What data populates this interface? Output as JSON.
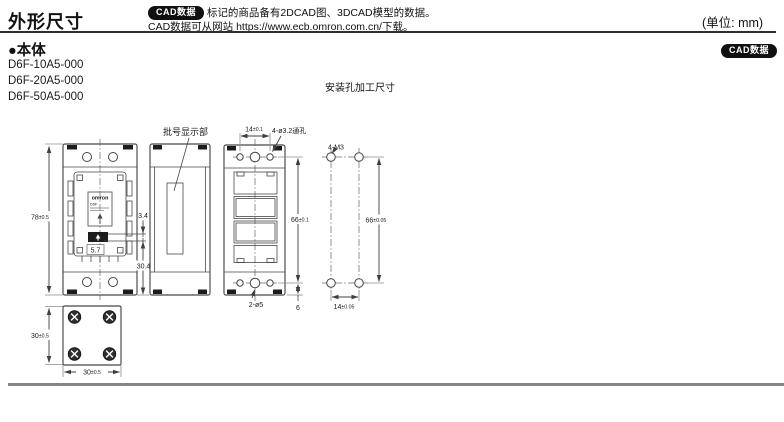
{
  "header": {
    "title": "外形尺寸",
    "cad_badge": "CAD数据",
    "note_line1": "标记的商品备有2DCAD图、3DCAD模型的数据。",
    "note_line2": "CAD数据可从网站 https://www.ecb.omron.com.cn/下载。",
    "unit_label": "(单位: mm)"
  },
  "section": {
    "heading": "●本体",
    "cad_badge": "CAD数据",
    "models": [
      "D6F-10A5-000",
      "D6F-20A5-000",
      "D6F-50A5-000"
    ],
    "mounting_title": "安装孔加工尺寸"
  },
  "front_view": {
    "height_dim": "78",
    "height_tol": "±0.5",
    "logo": "omron",
    "logo_model": "D6F",
    "dim_3_4": "3.4",
    "dim_5_7": "5.7",
    "dim_30_4": "30.4"
  },
  "side_view": {
    "callout": "批号显示部"
  },
  "back_view": {
    "top_dim": "14",
    "top_tol": "±0.1",
    "holes_label": "4-ø3.2通孔",
    "height_dim": "66",
    "height_tol": "±0.1",
    "center_holes_label": "2-ø5",
    "bottom_offset_dim": "6"
  },
  "mounting_view": {
    "screws_label": "4-M3",
    "height_dim": "66",
    "height_tol": "±0.05",
    "width_dim": "14",
    "width_tol": "±0.05"
  },
  "bottom_view": {
    "height_dim": "30",
    "height_tol": "±0.5",
    "width_dim": "30",
    "width_tol": "±0.5"
  },
  "colors": {
    "line": "#474747",
    "badge_bg": "#101010",
    "top_rule": "#2e2e2e",
    "footer_rule": "#858585"
  }
}
